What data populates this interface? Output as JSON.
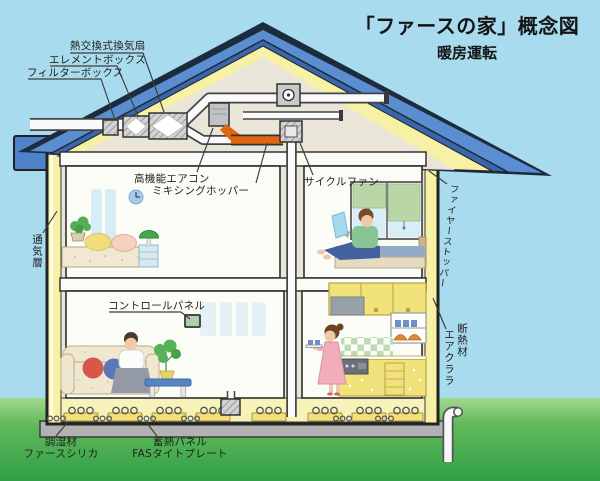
{
  "title": "「ファースの家」概念図",
  "subtitle": "暖房運転",
  "labels": {
    "heat_exchange_fan": "熱交換式換気扇",
    "element_box": "エレメントボックス",
    "filter_box": "フィルターボックス",
    "high_performance_aircon": "高機能エアコン",
    "mixing_hopper": "ミキシングホッパー",
    "cycle_fan": "サイクルファン",
    "fire_stopper": "ファイヤーストッパー",
    "ventilation_layer": "通気層",
    "control_panel": "コントロールパネル",
    "insulation_material": "断熱材",
    "air_clara": "エアクララ",
    "humidity_conditioner": "調湿材",
    "fas_silica": "ファースシリカ",
    "heat_storage_panel": "蓄熱パネル",
    "fas_tight_plate": "FASタイトプレート"
  },
  "colors": {
    "sky": "#a8dbee",
    "grass_top": "#a5d98e",
    "grass_bottom": "#2f9e45",
    "roof_blue": "#5b8ed1",
    "roof_shadow_blue": "#3a66ab",
    "insulation_yellow": "#f6f1a4",
    "duct_orange": "#e2660f",
    "wall_interior": "#e9e5d8",
    "room_white": "#fcfcf6"
  }
}
